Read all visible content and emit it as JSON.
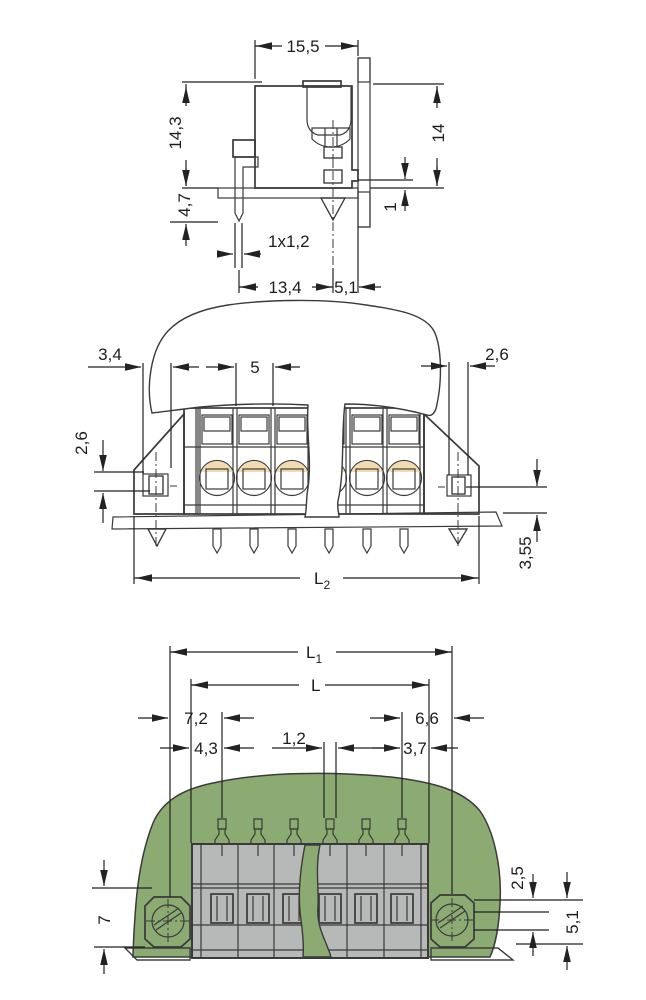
{
  "drawing": {
    "kind": "terminal-block dimensional drawing, 3 orthographic views",
    "colors": {
      "housing_gray": "#b6b9b7",
      "outline": "#3a3a3a",
      "wire_slot_yellow": "#ffd800",
      "clamp_cream": "#f2dbb0",
      "pin_orange": "#f2b87c",
      "screw_blue": "#bdd2df",
      "pcb_green": "#74a471",
      "panel_green": "#8cab73",
      "dimension_ink": "#222222"
    },
    "views": {
      "side": {
        "name": "side section view",
        "dims": {
          "width_top": "15,5",
          "height_overall": "14,3",
          "pin_length": "4,7",
          "pin_section": "1x1,2",
          "pin_to_screw": "13,4",
          "screw_to_panel": "5,1",
          "height_panel": "14",
          "panel_offset": "1"
        }
      },
      "front": {
        "name": "front view",
        "dims": {
          "end_offset": "3,4",
          "pitch": "5",
          "slot_height": "2,6",
          "slot_width": "2,6",
          "pcb_offset": "3,55",
          "length_total": {
            "main": "L",
            "sub": "2"
          }
        }
      },
      "plan": {
        "name": "top view on panel",
        "dims": {
          "length_flange": {
            "main": "L",
            "sub": "1"
          },
          "length_body": {
            "main": "L",
            "sub": ""
          },
          "screw_to_pin1": "7,2",
          "pin_last_to_screw": "6,6",
          "edge_to_pin1": "4,3",
          "pin_width": "1,2",
          "pin_last_to_edge": "3,7",
          "flange_height": "7",
          "body_offset": "2,5",
          "body_depth": "5,1"
        }
      }
    }
  }
}
